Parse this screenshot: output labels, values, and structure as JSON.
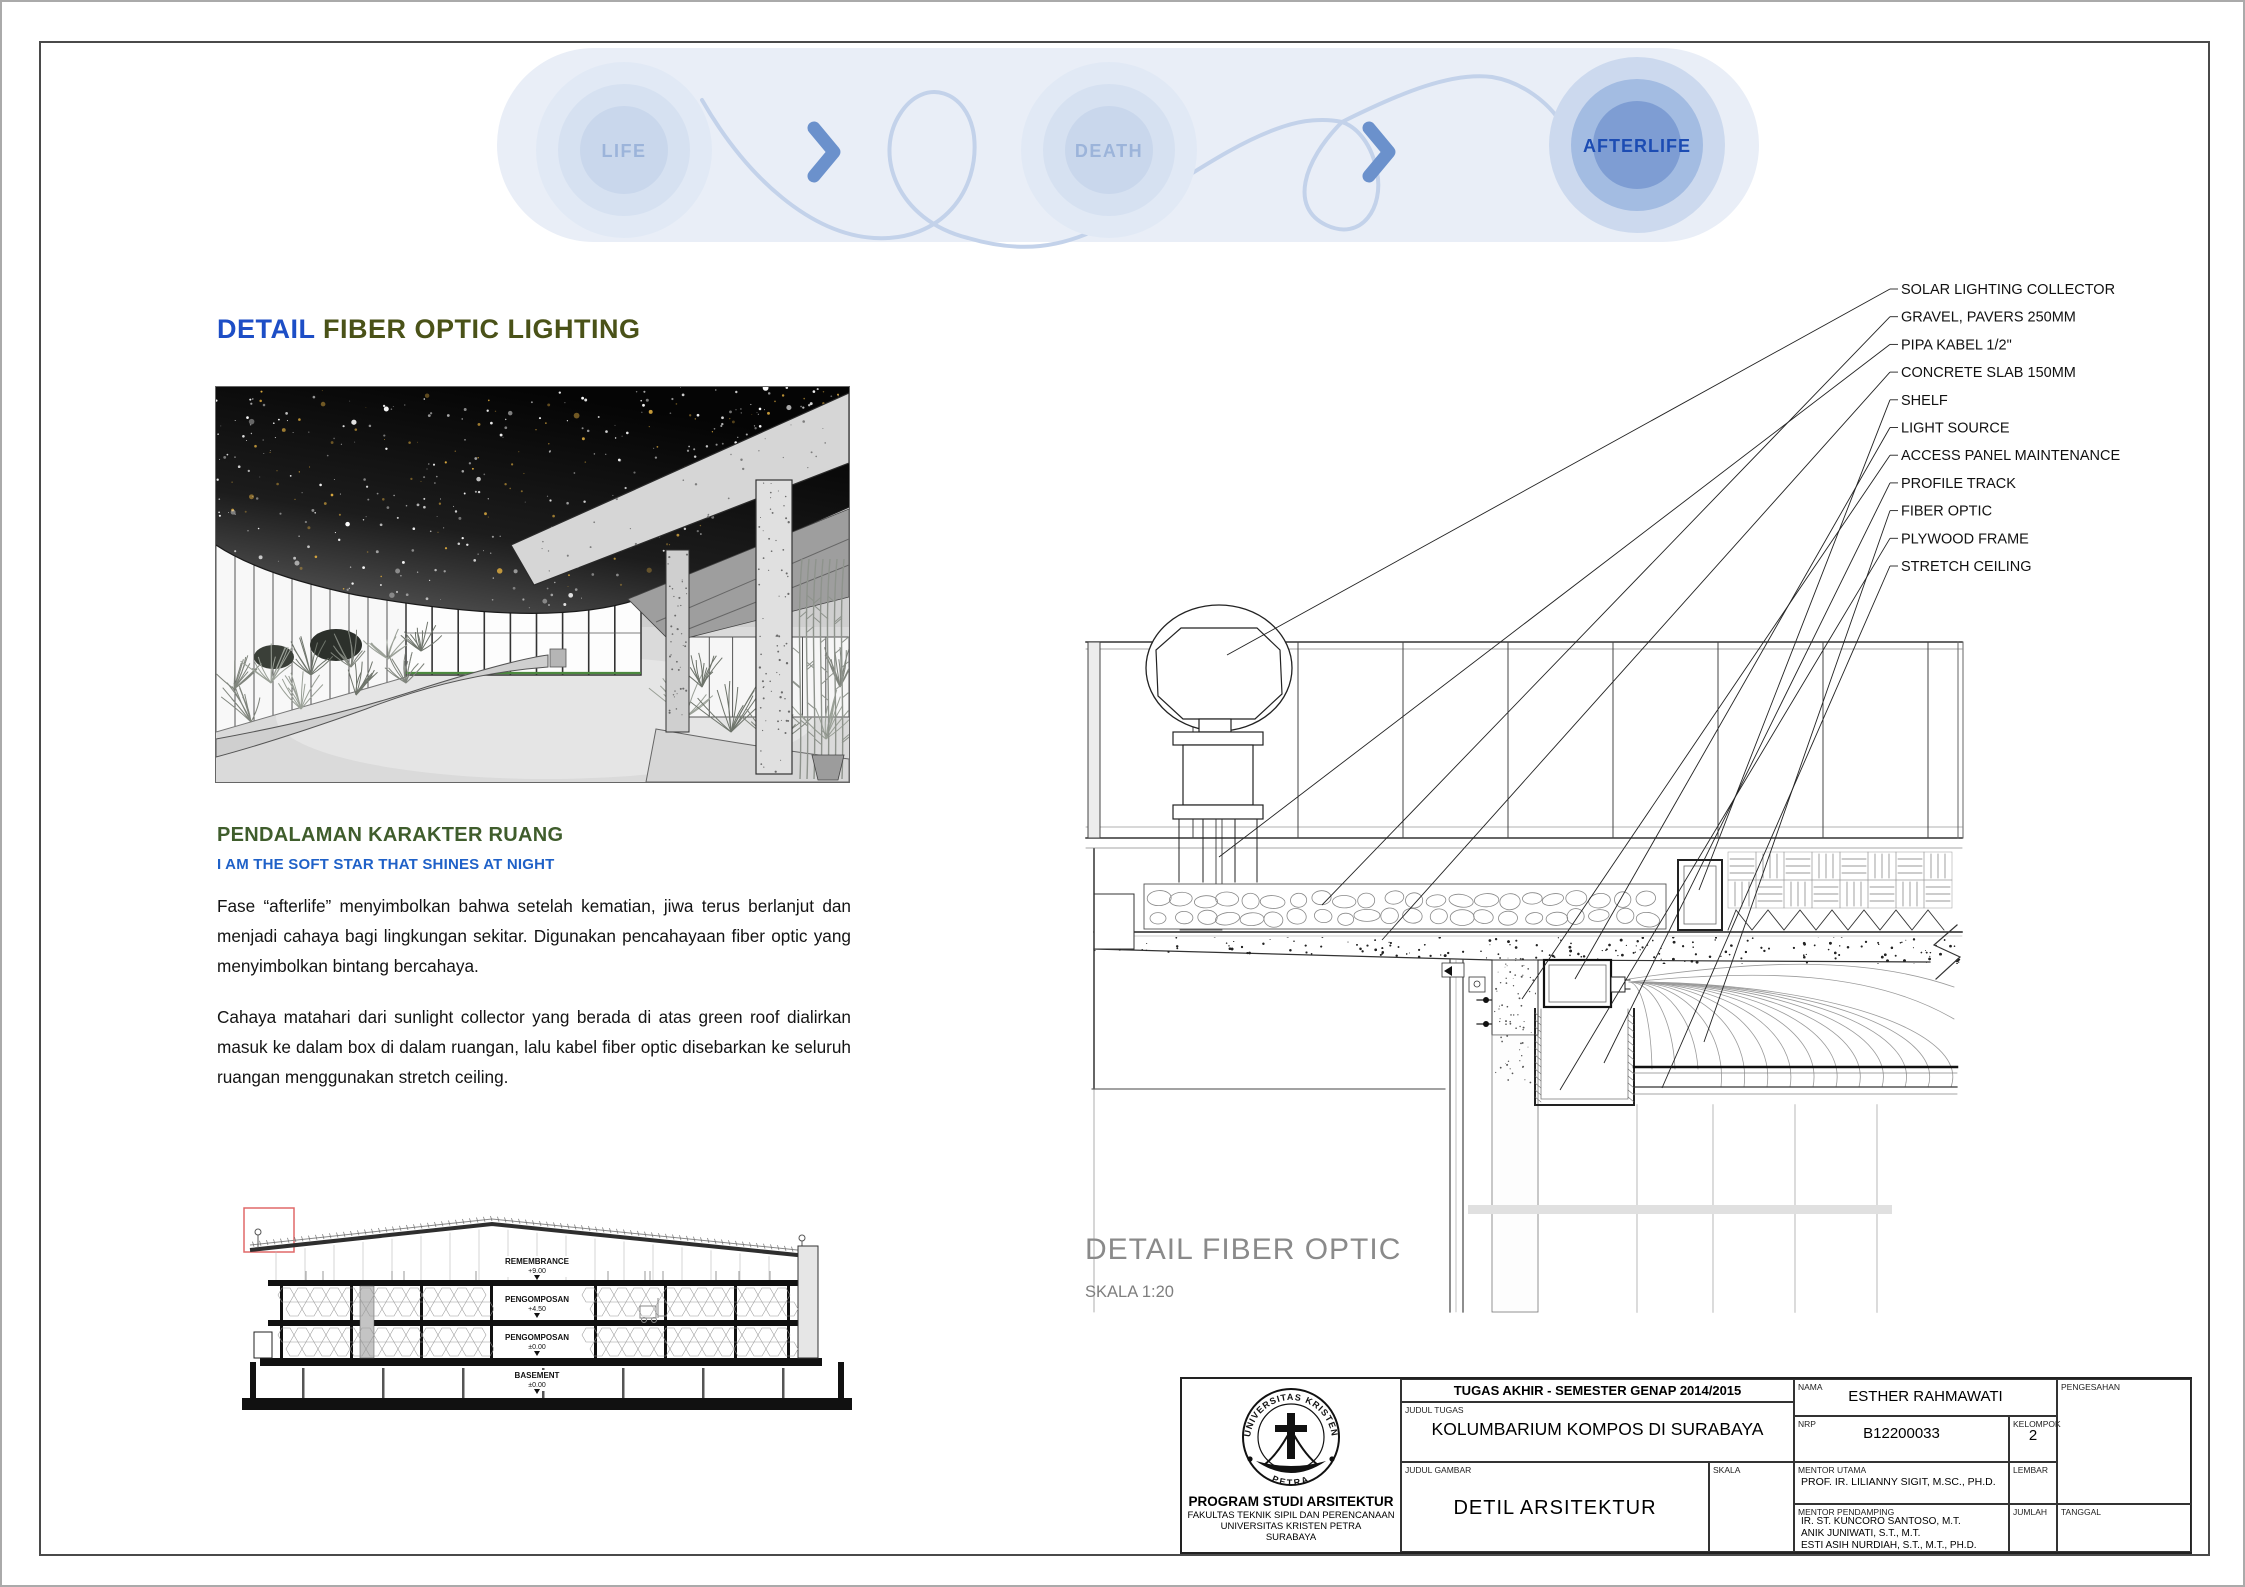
{
  "flow": {
    "nodes": [
      {
        "label": "LIFE",
        "active": false
      },
      {
        "label": "DEATH",
        "active": false
      },
      {
        "label": "AFTERLIFE",
        "active": true
      }
    ],
    "inactive_text_color": "#9cb4da",
    "active_text_color": "#1c4cb3",
    "chevron_color": "#6b91cc",
    "pill_color": "#e9eef7"
  },
  "left": {
    "title_blue": "DETAIL",
    "title_olive": "FIBER OPTIC LIGHTING",
    "section_heading": "PENDALAMAN KARAKTER RUANG",
    "section_subheading": "I AM THE SOFT STAR THAT SHINES AT NIGHT",
    "paragraph1": "Fase “afterlife” menyimbolkan bahwa setelah kematian, jiwa terus berlanjut dan menjadi cahaya bagi lingkungan sekitar. Digunakan pencahayaan fiber optic yang menyimbolkan bintang bercahaya.",
    "paragraph2": "Cahaya matahari dari sunlight collector yang berada di atas green roof dialirkan masuk ke dalam box di dalam ruangan, lalu kabel fiber optic disebarkan ke seluruh ruangan menggunakan stretch ceiling.",
    "section_levels": [
      {
        "name": "REMEMBRANCE",
        "elev": "+9.00"
      },
      {
        "name": "PENGOMPOSAN",
        "elev": "+4.50"
      },
      {
        "name": "PENGOMPOSAN",
        "elev": "±0.00"
      },
      {
        "name": "BASEMENT",
        "elev": "±0.00"
      }
    ]
  },
  "detail": {
    "callouts": [
      "SOLAR LIGHTING COLLECTOR",
      "GRAVEL, PAVERS 250MM",
      "PIPA KABEL 1/2\"",
      "CONCRETE SLAB 150MM",
      "SHELF",
      "LIGHT SOURCE",
      "ACCESS PANEL MAINTENANCE",
      "PROFILE TRACK",
      "FIBER OPTIC",
      "PLYWOOD FRAME",
      "STRETCH CEILING"
    ],
    "title": "DETAIL FIBER OPTIC",
    "scale": "SKALA 1:20"
  },
  "titleblock": {
    "logo_top": "UNIVERSITAS KRISTEN",
    "logo_bottom": "PETRA",
    "program": "PROGRAM STUDI ARSITEKTUR",
    "faculty": "FAKULTAS TEKNIK SIPIL DAN PERENCANAAN",
    "university": "UNIVERSITAS KRISTEN PETRA",
    "city": "SURABAYA",
    "header": "TUGAS AKHIR - SEMESTER GENAP 2014/2015",
    "judul_tugas_label": "JUDUL TUGAS",
    "judul_tugas": "KOLUMBARIUM KOMPOS DI SURABAYA",
    "judul_gambar_label": "JUDUL GAMBAR",
    "judul_gambar": "DETIL ARSITEKTUR",
    "skala_label": "SKALA",
    "nama_label": "NAMA",
    "nama": "ESTHER RAHMAWATI",
    "nrp_label": "NRP",
    "nrp": "B12200033",
    "kelompok_label": "KELOMPOK",
    "kelompok": "2",
    "mentor_utama_label": "MENTOR UTAMA",
    "mentor_utama": "PROF. IR. LILIANNY SIGIT, M.SC., PH.D.",
    "mentor_pendamping_label": "MENTOR PENDAMPING",
    "mentor_pendamping": [
      "IR. ST. KUNCORO SANTOSO, M.T.",
      "ANIK JUNIWATI, S.T., M.T.",
      "ESTI ASIH NURDIAH, S.T., M.T., PH.D."
    ],
    "lembar_label": "LEMBAR",
    "jumlah_label": "JUMLAH",
    "tanggal_label": "TANGGAL",
    "pengesahan_label": "PENGESAHAN"
  }
}
